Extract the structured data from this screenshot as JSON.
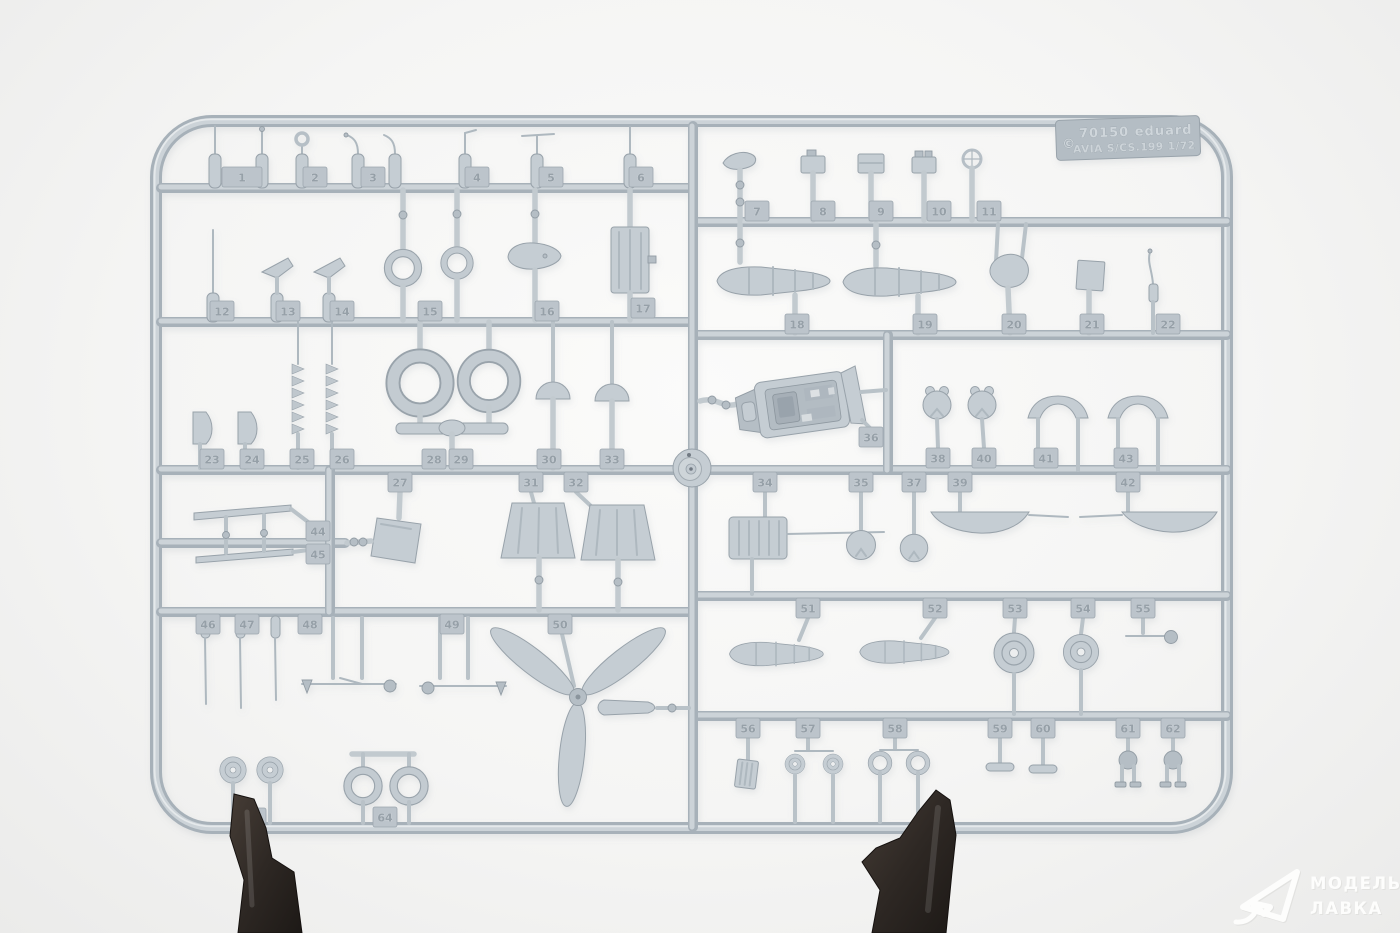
{
  "photo": {
    "label_plate": {
      "copyright_mark": "©",
      "line1": "70150  eduard",
      "line2": "AVIA S/CS.199  1/72"
    },
    "watermark": {
      "line1": "МОДЕЛЬНАЯ",
      "line2": "ЛАВКА"
    },
    "colors": {
      "background": "#f3f3f2",
      "plastic": "#c5cdd3",
      "plastic_shadow": "#98a2aa",
      "plastic_highlight": "#e9ecee",
      "clamp_dark": "#2e2824",
      "watermark_white": "#fdfdfc"
    },
    "tabs": {
      "n1": "1",
      "n2": "2",
      "n3": "3",
      "n4": "4",
      "n5": "5",
      "n6": "6",
      "n7": "7",
      "n8": "8",
      "n9": "9",
      "n10": "10",
      "n11": "11",
      "n12": "12",
      "n13": "13",
      "n14": "14",
      "n15": "15",
      "n16": "16",
      "n17": "17",
      "n18": "18",
      "n19": "19",
      "n20": "20",
      "n21": "21",
      "n22": "22",
      "n23": "23",
      "n24": "24",
      "n25": "25",
      "n26": "26",
      "n27": "27",
      "n28": "28",
      "n29": "29",
      "n30": "30",
      "n31": "31",
      "n32": "32",
      "n33": "33",
      "n34": "34",
      "n35": "35",
      "n36": "36",
      "n37": "37",
      "n38": "38",
      "n39": "39",
      "n40": "40",
      "n41": "41",
      "n42": "42",
      "n43": "43",
      "n44": "44",
      "n45": "45",
      "n46": "46",
      "n47": "47",
      "n48": "48",
      "n49": "49",
      "n50": "50",
      "n51": "51",
      "n52": "52",
      "n53": "53",
      "n54": "54",
      "n55": "55",
      "n56": "56",
      "n57": "57",
      "n58": "58",
      "n59": "59",
      "n60": "60",
      "n61": "61",
      "n62": "62",
      "n64": "64"
    }
  }
}
